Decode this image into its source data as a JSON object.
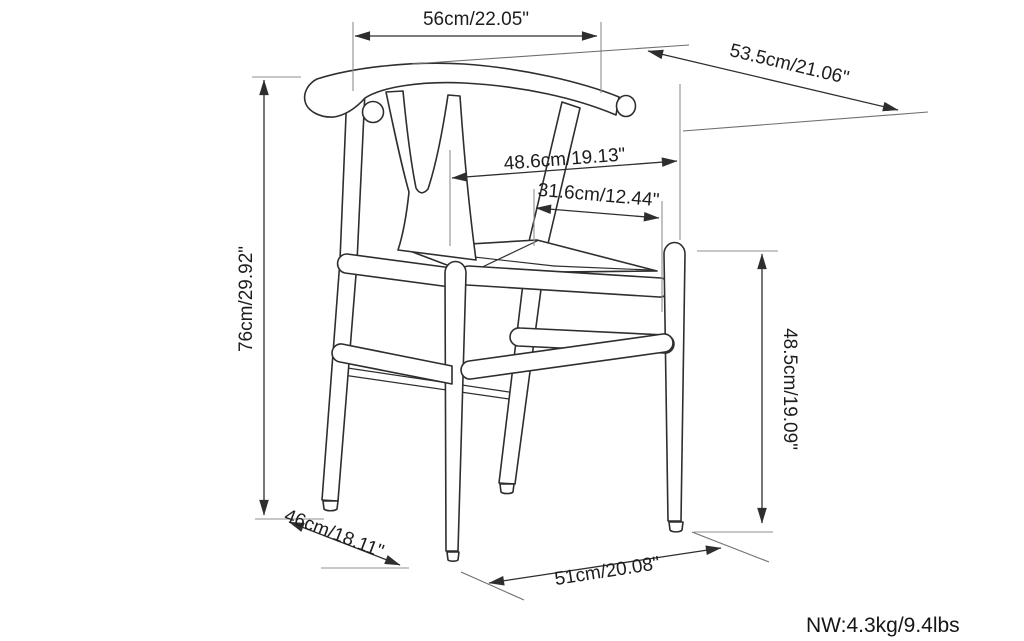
{
  "diagram": {
    "title": "wishbone-chair-dimension-drawing",
    "net_weight_label": "NW:4.3kg/9.4lbs",
    "dimensions": {
      "top_back_width": "56cm/22.05\"",
      "diagonal_overall_depth": "53.5cm/21.06\"",
      "backrest_inner_width": "48.6cm/19.13\"",
      "seat_depth": "31.6cm/12.44\"",
      "overall_height": "76cm/29.92\"",
      "arm_height": "48.5cm/19.09\"",
      "base_side_depth": "46cm/18.11\"",
      "seat_front_width": "51cm/20.08\""
    },
    "colors": {
      "chair_line": "#2e2e2e",
      "dimension_line": "#2e2e2e",
      "extension_line": "#8f8f8f",
      "text": "#1d1d1d",
      "background": "#ffffff"
    }
  }
}
